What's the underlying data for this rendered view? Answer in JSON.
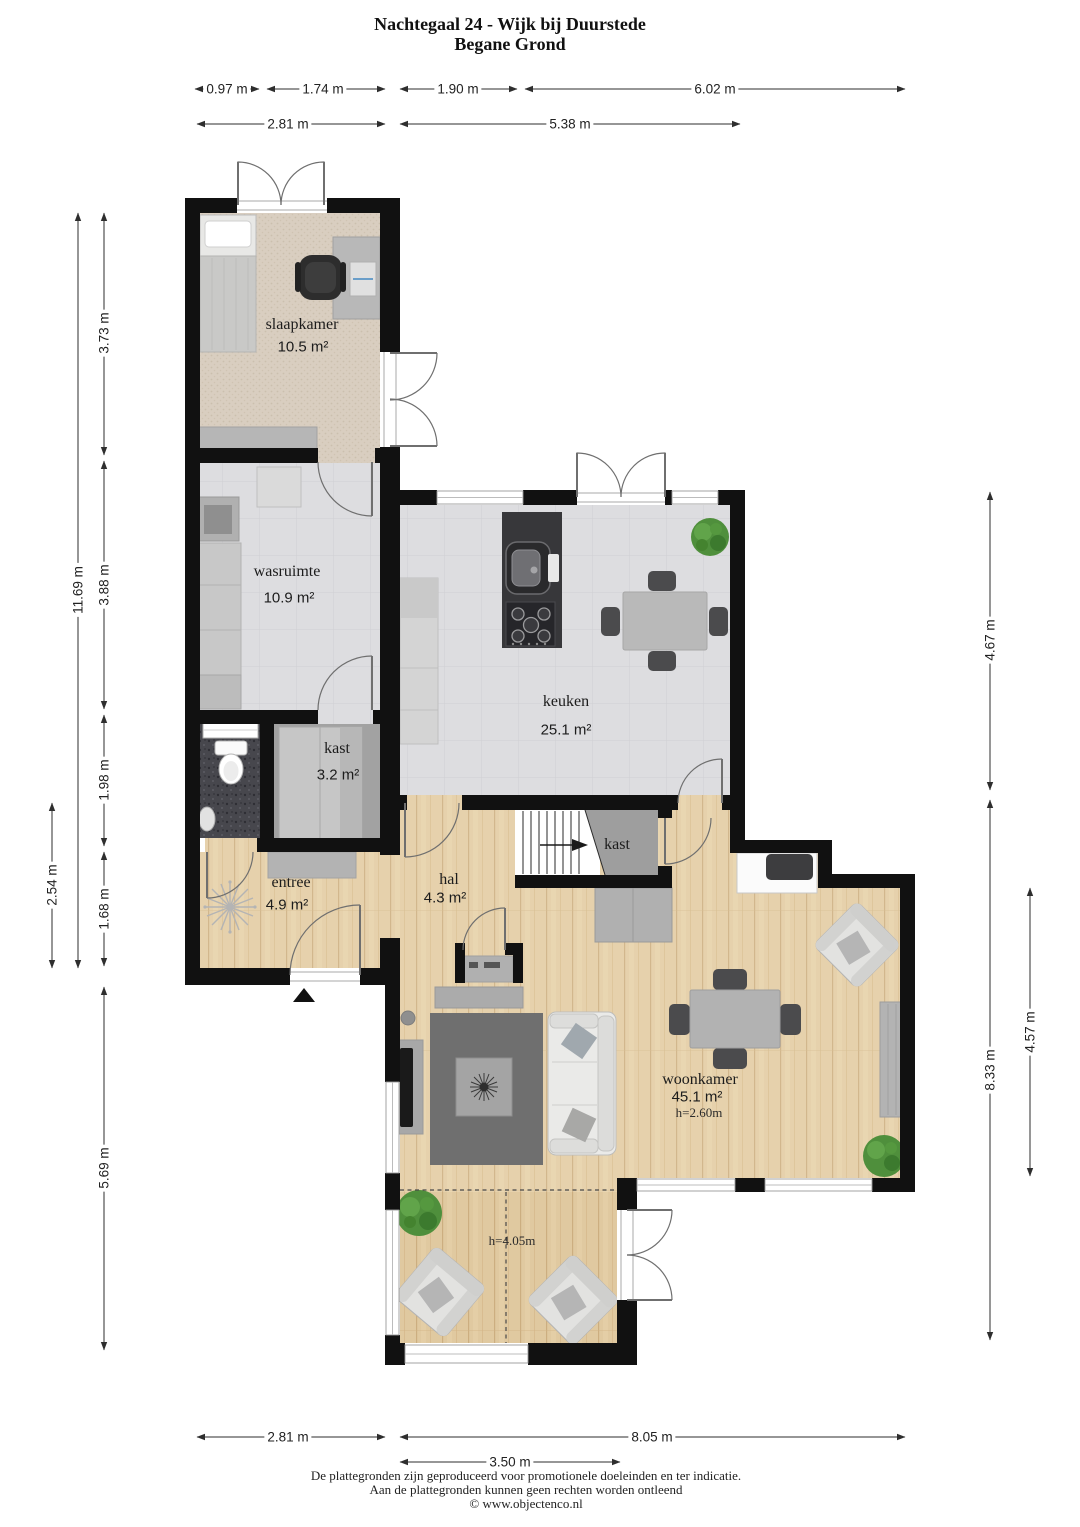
{
  "header": {
    "title": "Nachtegaal 24 - Wijk bij Duurstede",
    "subtitle": "Begane Grond"
  },
  "rooms": {
    "slaapkamer": {
      "label": "slaapkamer",
      "area": "10.5 m²"
    },
    "wasruimte": {
      "label": "wasruimte",
      "area": "10.9 m²"
    },
    "kast_begane": {
      "label": "kast",
      "area": "3.2 m²"
    },
    "entree": {
      "label": "entree",
      "area": "4.9 m²"
    },
    "hal": {
      "label": "hal",
      "area": "4.3 m²"
    },
    "keuken": {
      "label": "keuken",
      "area": "25.1 m²"
    },
    "trapkast": {
      "label": "kast"
    },
    "woonkamer": {
      "label": "woonkamer",
      "area": "45.1 m²",
      "ceiling": "h=2.60m"
    },
    "serre": {
      "ceiling": "h=4.05m"
    }
  },
  "dimensions": {
    "top_row1": [
      "0.97 m",
      "1.74 m",
      "1.90 m",
      "6.02 m"
    ],
    "top_row2": [
      "2.81 m",
      "5.38 m"
    ],
    "left_segments": [
      "3.73 m",
      "3.88 m",
      "1.98 m",
      "1.68 m",
      "5.69 m"
    ],
    "left_main": "11.69 m",
    "left_outer": "2.54 m",
    "right_main": [
      "4.67 m",
      "8.33 m"
    ],
    "right_inner": "4.57 m",
    "bottom_row1": [
      "2.81 m",
      "8.05 m"
    ],
    "bottom_row2": [
      "3.50 m"
    ]
  },
  "footer": {
    "line1": "De plattegronden zijn geproduceerd voor promotionele doeleinden en ter indicatie.",
    "line2": "Aan de plattegronden kunnen geen rechten worden ontleend",
    "line3": "© www.objectenco.nl"
  },
  "colors": {
    "wall": "#111111",
    "wood_floor": "#e6d1ac",
    "tile_floor": "#dddde0",
    "carpet_floor": "#d9cec0",
    "bath_floor": "#47474d",
    "closet_floor": "#a2a2a2",
    "plant_green": "#4f8f3c",
    "dimension_text": "#222222"
  }
}
